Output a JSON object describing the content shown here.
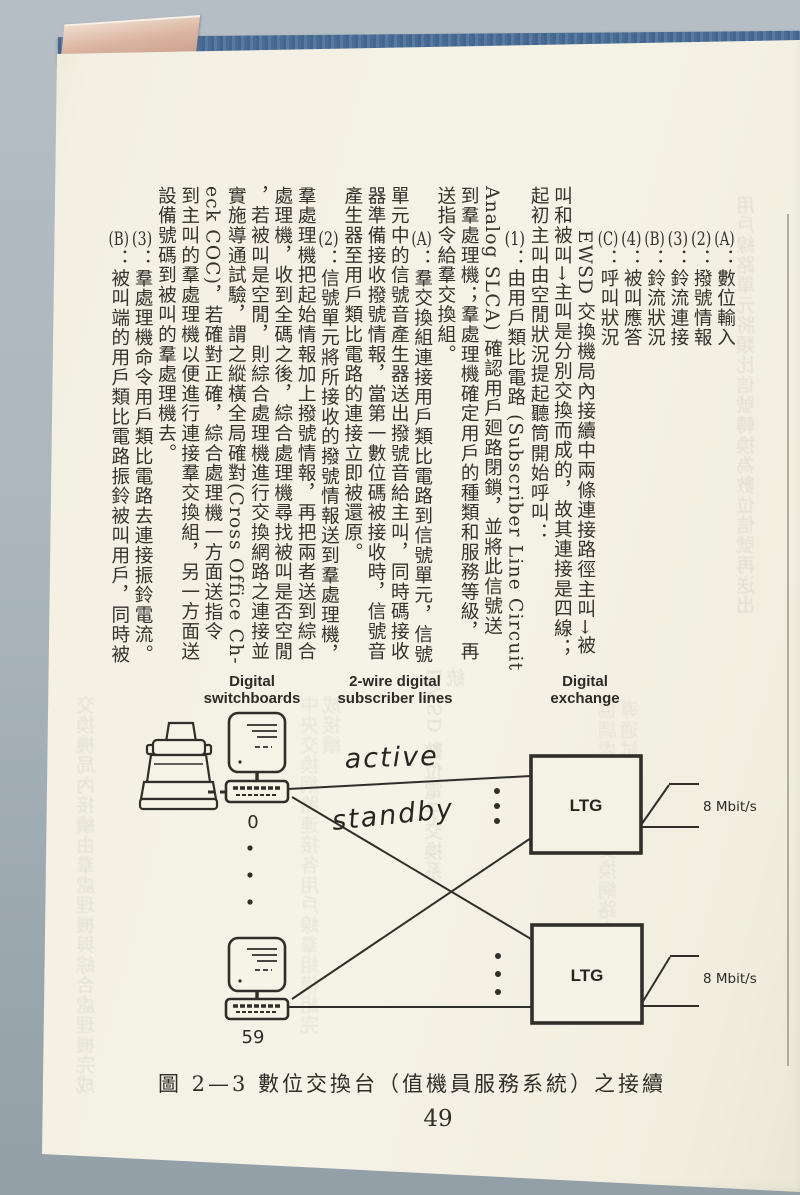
{
  "page_number": "49",
  "caption": "圖 2—3  數位交換台（值機員服務系統）之接續",
  "colors": {
    "background": "#a8b3ba",
    "page": "#f3f0e4",
    "ink": "#2f2e28",
    "cover_blue": "#4c6e94",
    "bookmark_pink": "#d9b5a3"
  },
  "article": {
    "columns": [
      {
        "marker": "(A)",
        "text": "：數位輸入",
        "indent": true
      },
      {
        "marker": "(2)",
        "text": "：撥號情報",
        "indent": true
      },
      {
        "marker": "(3)",
        "text": "：鈴流連接",
        "indent": true
      },
      {
        "marker": "(B)",
        "text": "：鈴流狀況",
        "indent": true
      },
      {
        "marker": "(4)",
        "text": "：被叫應答",
        "indent": true
      },
      {
        "marker": "(C)",
        "text": "：呼叫狀況",
        "indent": true
      },
      {
        "marker": "",
        "text": "EWSD 交換機局內接續中兩條連接路徑主叫→被",
        "indent": true
      },
      {
        "marker": "",
        "text": "叫和被叫→主叫是分別交換而成的，故其連接是四線；",
        "indent": false
      },
      {
        "marker": "",
        "text": "起初主叫由空閒狀況提起聽筒開始呼叫：",
        "indent": false
      },
      {
        "marker": "(1)",
        "text": "：由用戶類比電路 (Subscriber Line Circuit",
        "indent": true
      },
      {
        "marker": "",
        "text": "Analog SLCA) 確認用戶廻路閉鎖，並將此信號送",
        "indent": false
      },
      {
        "marker": "",
        "text": "到羣處理機；羣處理機確定用戶的種類和服務等級，再",
        "indent": false
      },
      {
        "marker": "",
        "text": "送指令給羣交換組。",
        "indent": false
      },
      {
        "marker": "(A)",
        "text": "：羣交換組連接用戶類比電路到信號單元，信號",
        "indent": true
      },
      {
        "marker": "",
        "text": "單元中的信號音產生器送出撥號音給主叫，同時碼接收",
        "indent": false
      },
      {
        "marker": "",
        "text": "器準備接收撥號情報，當第一數位碼被接收時，信號音",
        "indent": false
      },
      {
        "marker": "",
        "text": "產生器至用戶類比電路的連接立即被還原。",
        "indent": false
      },
      {
        "marker": "(2)",
        "text": "：信號單元將所接收的撥號情報送到羣處理機，",
        "indent": true
      },
      {
        "marker": "",
        "text": "羣處理機把起始情報加上撥號情報，再把兩者送到綜合",
        "indent": false
      },
      {
        "marker": "",
        "text": "處理機，收到全碼之後，綜合處理機尋找被叫是否空閒",
        "indent": false
      },
      {
        "marker": "",
        "text": "，若被叫是空閒，則綜合處理機進行交換網路之連接並",
        "indent": false
      },
      {
        "marker": "",
        "text": "實施導通試驗，謂之縱橫全局確對(Cross Office Ch-",
        "indent": false
      },
      {
        "marker": "",
        "text": "eck COC)，若確對正確，綜合處理機一方面送指令",
        "indent": false
      },
      {
        "marker": "",
        "text": "到主叫的羣處理機以便進行連接羣交換組，另一方面送",
        "indent": false
      },
      {
        "marker": "",
        "text": "設備號碼到被叫的羣處理機去。",
        "indent": false
      },
      {
        "marker": "(3)",
        "text": "：羣處理機命令用戶類比電路去連接振鈴電流。",
        "indent": true
      },
      {
        "marker": "(B)",
        "text": "：被叫端的用戶類比電路振鈴被叫用戶，同時被",
        "indent": true
      }
    ]
  },
  "diagram": {
    "headers": [
      {
        "line1": "Digital",
        "line2": "switchboards"
      },
      {
        "line1": "2-wire digital",
        "line2": "subscriber lines"
      },
      {
        "line1": "Digital",
        "line2": "exchange"
      }
    ],
    "active_label": "active",
    "standby_label": "standby",
    "terminals": [
      {
        "number": "0"
      },
      {
        "number": "59"
      }
    ],
    "ltg_boxes": [
      {
        "label": "LTG",
        "rate": "8 Mbit/s"
      },
      {
        "label": "LTG",
        "rate": "8 Mbit/s"
      }
    ]
  },
  "bleedthrough": {
    "lines": [
      "用戶線路單元將類比信號轉換為數位信號再送出",
      "協調處理機控制交換網路之連接並作導通試驗",
      "EWSD 數位電子交換系統",
      "中央交換網路連接各用戶線羣組模組完成接續",
      "交換機局內接續由羣處理機與綜合處理機完成"
    ]
  }
}
